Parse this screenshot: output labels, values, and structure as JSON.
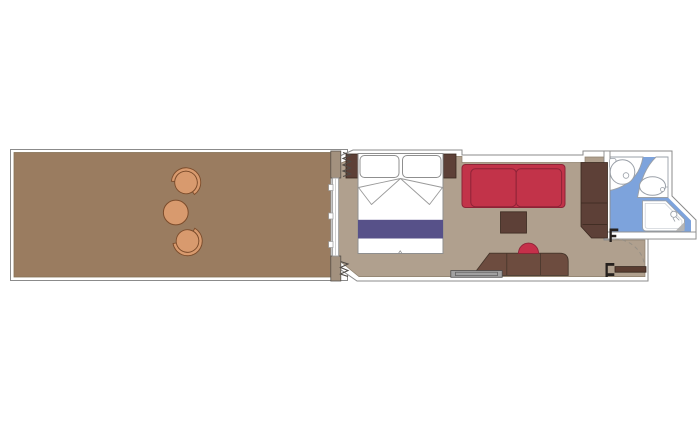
{
  "document": {
    "type": "floor-plan",
    "subject": "cruise-ship-balcony-cabin",
    "background": "#ffffff"
  },
  "colors": {
    "wall_line": "#8b8b8b",
    "wall_fill": "#ffffff",
    "balcony_floor": "#9a7c60",
    "balcony_floor_edge": "#857256",
    "cabin_floor": "#b0a08e",
    "cabin_floor_edge": "#8d806d",
    "bathroom_floor": "#7da3dc",
    "divider_wall": "#a3917e",
    "dark_wood": "#5d4037",
    "desk_wood": "#6d4c3f",
    "wood_outline": "#3a281f",
    "sofa_red": "#c23349",
    "sofa_outline": "#8e2337",
    "stool_red": "#c5304a",
    "bed_runner": "#575189",
    "bed_outline": "#8f8f8f",
    "chair_tan": "#d89a6e",
    "chair_outline": "#7c4c2b",
    "fixture_line": "#9aa0a8",
    "bench_gray": "#a1a1a1",
    "door_wood": "#5a3d31",
    "symbol_dark": "#26211e",
    "shade_gray": "#b5b5b5",
    "curtain_line": "#4f4a45"
  },
  "rooms": [
    {
      "name": "balcony",
      "floor_color_key": "balcony_floor",
      "items": [
        "lounge-chair",
        "round-side-table",
        "lounge-chair"
      ]
    },
    {
      "name": "cabin",
      "floor_color_key": "cabin_floor",
      "items": [
        "double-bed",
        "pillow",
        "pillow",
        "bed-runner",
        "nightstand",
        "nightstand",
        "sofa",
        "coffee-table",
        "wardrobe",
        "desk-dresser",
        "stool",
        "luggage-bench",
        "sliding-balcony-door",
        "curtain",
        "curtain",
        "entry-door"
      ]
    },
    {
      "name": "bathroom",
      "floor_color_key": "bathroom_floor",
      "items": [
        "washbasin",
        "toilet",
        "shower"
      ]
    }
  ]
}
